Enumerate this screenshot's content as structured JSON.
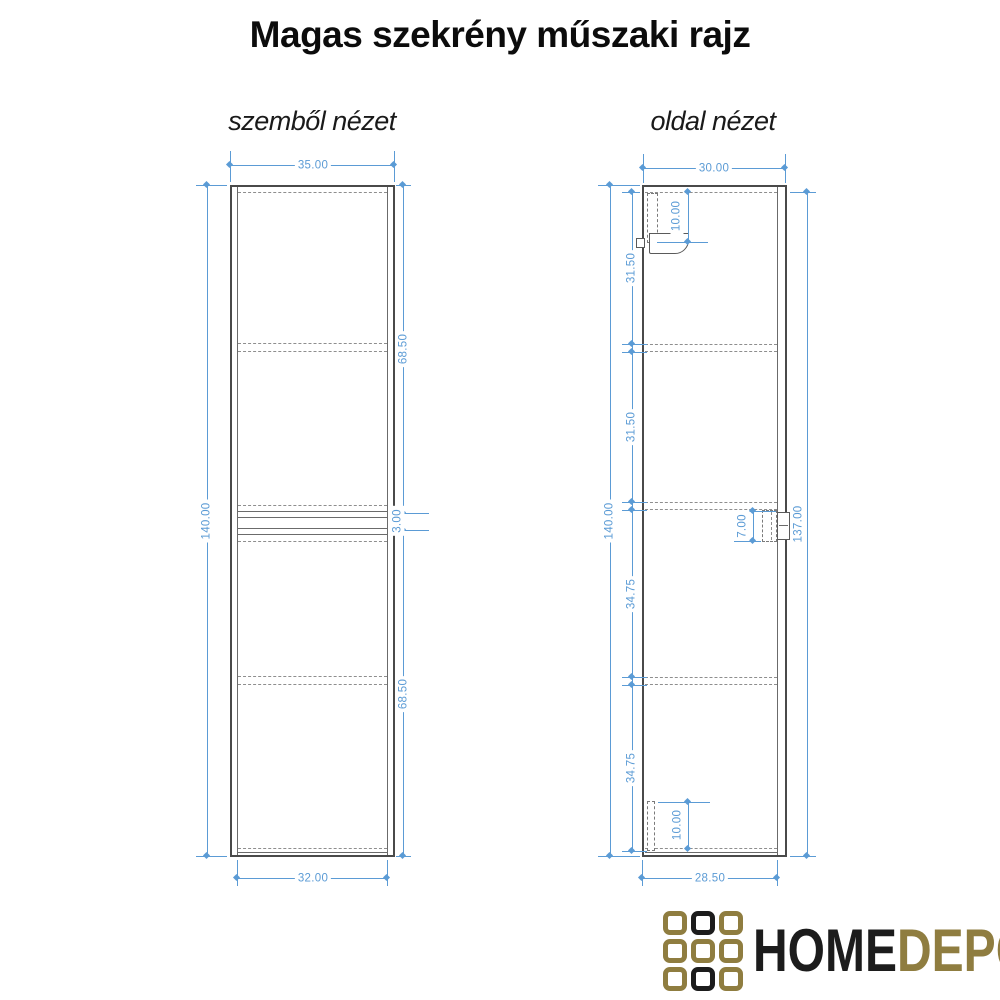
{
  "title": "Magas szekrény műszaki rajz",
  "front_view": {
    "label": "szemből nézet",
    "dims": {
      "width_top": "35.00",
      "width_bottom": "32.00",
      "height_total": "140.00",
      "door_upper": "68.50",
      "door_gap": "3.00",
      "door_lower": "68.50"
    }
  },
  "side_view": {
    "label": "oldal nézet",
    "dims": {
      "depth_top": "30.00",
      "depth_bottom": "28.50",
      "height_total": "140.00",
      "height_back": "137.00",
      "section_1": "31.50",
      "section_2": "31.50",
      "section_3": "34.75",
      "section_4": "34.75",
      "bracket_top": "10.00",
      "bracket_mid": "7.00",
      "bracket_bottom": "10.00"
    }
  },
  "logo": {
    "text_primary": "HOME",
    "text_secondary": "DEPO",
    "grid": [
      "gold",
      "black",
      "gold",
      "gold",
      "gold",
      "gold",
      "gold",
      "black",
      "gold"
    ]
  },
  "colors": {
    "dimension_blue": "#5b9bd5",
    "drawing_line": "#4a4a4a",
    "hidden_line": "#8e8e8e",
    "logo_gold": "#8f7d40",
    "logo_black": "#1c1c1c"
  }
}
